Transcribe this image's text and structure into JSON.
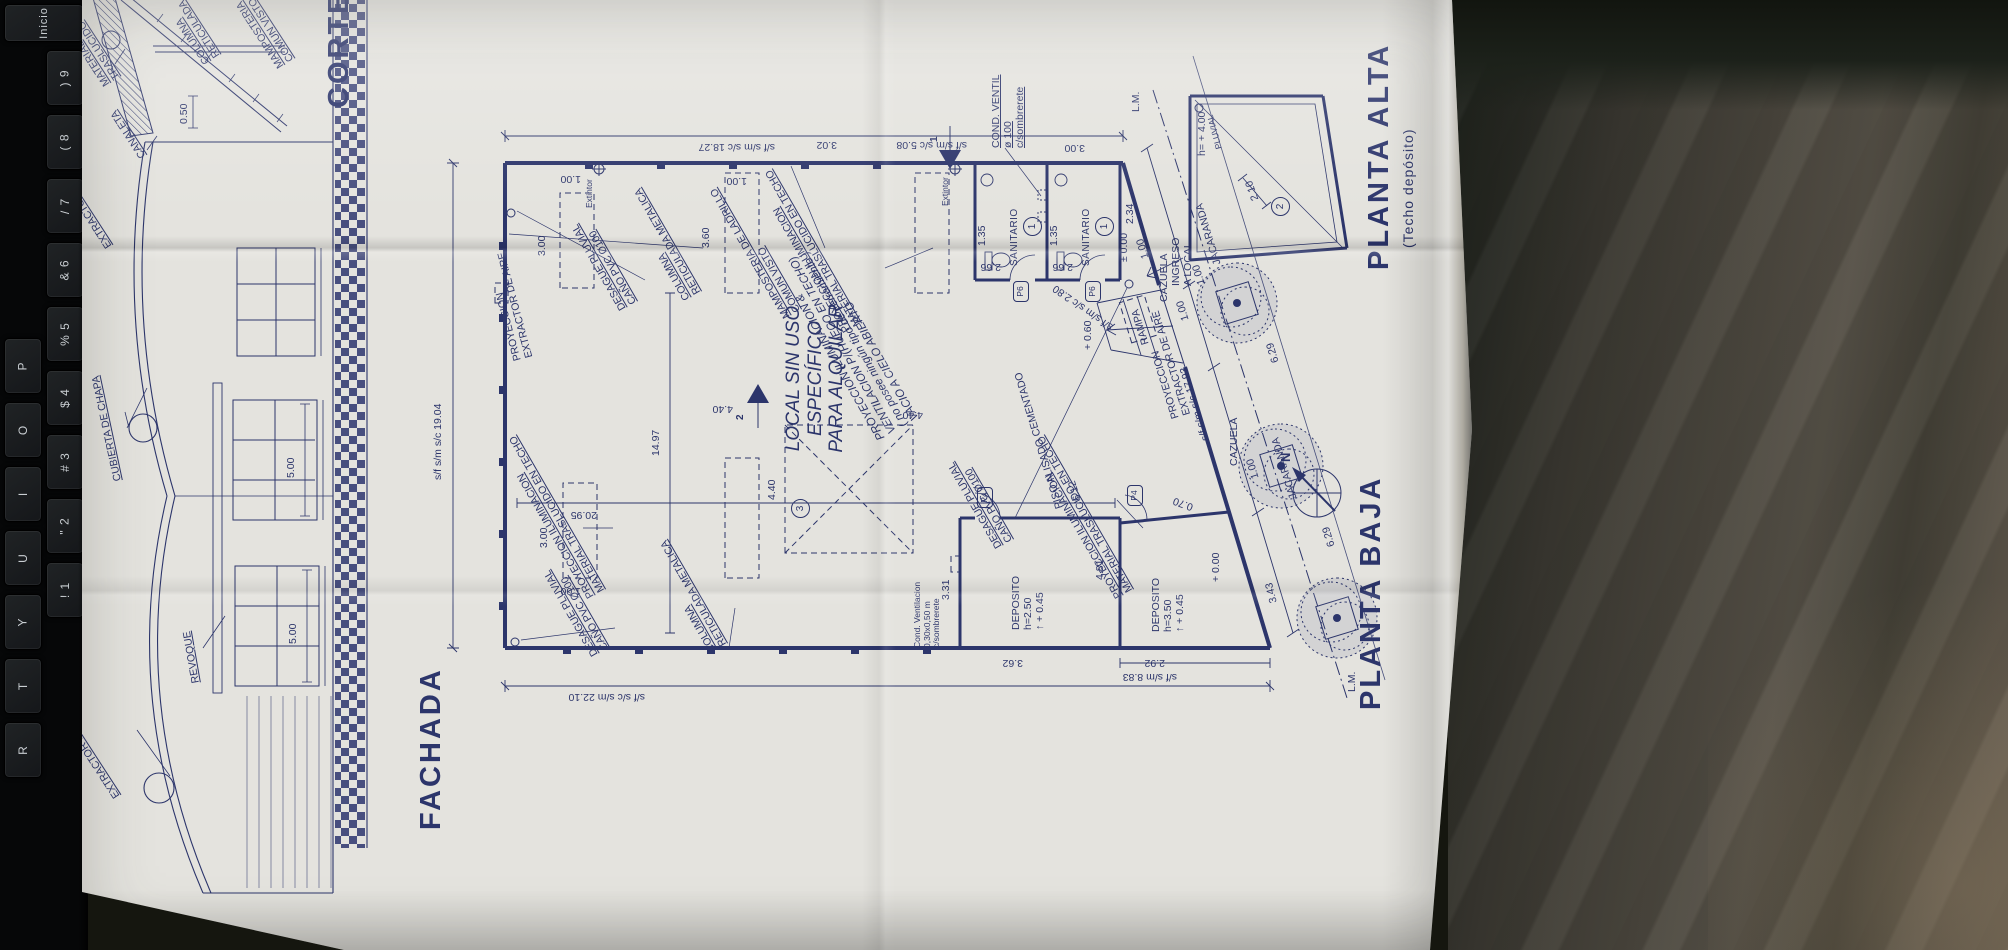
{
  "colors": {
    "ink": "#2c356b",
    "paper": "#e4e3de",
    "band": "#3a4277",
    "keyboard_key": "#1a1c1f",
    "key_text": "#c9ced2"
  },
  "keyboard": {
    "keys": [
      {
        "t": "Inicio",
        "x": 4,
        "y": 4,
        "w": 78,
        "h": 36,
        "fs": 11
      },
      {
        "t": ") 9",
        "x": 46,
        "y": 50,
        "w": 36,
        "h": 54
      },
      {
        "t": "( 8",
        "x": 46,
        "y": 114,
        "w": 36,
        "h": 54
      },
      {
        "t": "/ 7",
        "x": 46,
        "y": 178,
        "w": 36,
        "h": 54
      },
      {
        "t": "& 6",
        "x": 46,
        "y": 242,
        "w": 36,
        "h": 54
      },
      {
        "t": "% 5",
        "x": 46,
        "y": 306,
        "w": 36,
        "h": 54
      },
      {
        "t": "$ 4",
        "x": 46,
        "y": 370,
        "w": 36,
        "h": 54
      },
      {
        "t": "# 3",
        "x": 46,
        "y": 434,
        "w": 36,
        "h": 54
      },
      {
        "t": "\" 2",
        "x": 46,
        "y": 498,
        "w": 36,
        "h": 54
      },
      {
        "t": "! 1",
        "x": 46,
        "y": 562,
        "w": 36,
        "h": 54
      },
      {
        "t": "P",
        "x": 4,
        "y": 338,
        "w": 36,
        "h": 54
      },
      {
        "t": "O",
        "x": 4,
        "y": 402,
        "w": 36,
        "h": 54
      },
      {
        "t": "I",
        "x": 4,
        "y": 466,
        "w": 36,
        "h": 54
      },
      {
        "t": "U",
        "x": 4,
        "y": 530,
        "w": 36,
        "h": 54
      },
      {
        "t": "Y",
        "x": 4,
        "y": 594,
        "w": 36,
        "h": 54
      },
      {
        "t": "T",
        "x": 4,
        "y": 658,
        "w": 36,
        "h": 54
      },
      {
        "t": "R",
        "x": 4,
        "y": 722,
        "w": 36,
        "h": 54
      }
    ]
  },
  "titles": {
    "fachada": "FACHADA",
    "corte": "CORTE",
    "planta_baja": "PLANTA BAJA",
    "planta_alta": "PLANTA ALTA",
    "planta_alta_sub": "(Techo depósito)"
  },
  "labels": [
    {
      "n": "label-material-traslucido",
      "t": "MATERIAL TRASLUCIDO",
      "c": "lblu",
      "x": 860,
      "y": 18,
      "r": -33
    },
    {
      "n": "label-columna-reticulada-corte",
      "t": "COLUMNA\nRETICULADA",
      "c": "lblu",
      "x": 882,
      "y": 118,
      "r": -33
    },
    {
      "n": "label-mamposteria-corte",
      "t": "MAMPOSTERIA\nCOMUN VISTO",
      "c": "lblu",
      "x": 878,
      "y": 192,
      "r": -33
    },
    {
      "n": "label-canaleta",
      "t": "CANALETA",
      "c": "lblu",
      "x": 788,
      "y": 54,
      "r": -33
    },
    {
      "n": "dim-corte-050",
      "t": "0.50",
      "c": "dim",
      "x": 824,
      "y": 94,
      "r": 0
    },
    {
      "n": "label-extractor-corte",
      "t": "EXTRACTOR DE AIRE ø 0,80 m",
      "c": "lblu",
      "x": 698,
      "y": 20,
      "r": -33
    },
    {
      "n": "label-extractor-fachada",
      "t": "EXTRACTOR DE AIRE ø 0,80 m",
      "c": "lblu",
      "x": 148,
      "y": 28,
      "r": -33
    },
    {
      "n": "label-cubierta-chapa",
      "t": "CUBIERTA DE CHAPA",
      "c": "lblu",
      "x": 466,
      "y": 28,
      "r": -12
    },
    {
      "n": "label-revoque",
      "t": "REVOQUE",
      "c": "lblu",
      "x": 264,
      "y": 106,
      "r": -10
    },
    {
      "n": "dim-window-500-a",
      "t": "5.00",
      "c": "dim",
      "x": 304,
      "y": 203,
      "r": 0
    },
    {
      "n": "dim-window-500-b",
      "t": "5.00",
      "c": "dim",
      "x": 470,
      "y": 201,
      "r": 0
    },
    {
      "n": "title-fachada",
      "t": "FACHADA",
      "c": "ttl",
      "x": 118,
      "y": 330,
      "r": 0
    },
    {
      "n": "title-corte",
      "t": "CORTE",
      "c": "ttl",
      "x": 840,
      "y": 238,
      "r": 0
    },
    {
      "n": "dim-chain-top",
      "t": "s/f s/m s/c 19.04",
      "c": "dim",
      "x": 468,
      "y": 348,
      "r": 0
    },
    {
      "n": "dim-chain-right",
      "t": "s/f s/m s/c 18.27",
      "c": "dim",
      "x": 796,
      "y": 690,
      "r": -90
    },
    {
      "n": "dim-chain-left",
      "t": "s/f s/c s/m 22.10",
      "c": "dim",
      "x": 246,
      "y": 560,
      "r": -90
    },
    {
      "n": "dim-hall-width",
      "t": "14.97",
      "c": "dim",
      "x": 492,
      "y": 566,
      "r": 0
    },
    {
      "n": "dim-hall-length",
      "t": "20.95",
      "c": "dim",
      "x": 428,
      "y": 512,
      "r": -90
    },
    {
      "n": "dim-chain-883",
      "t": "s/f s/m 8.83",
      "c": "dim",
      "x": 266,
      "y": 1092,
      "r": -90
    },
    {
      "n": "dim-front-1793",
      "t": "s/f s/m s/c 17.93",
      "c": "dim",
      "x": 506,
      "y": 1116,
      "r": -17
    },
    {
      "n": "dim-front-280",
      "t": "s/f s/m s/c 2.80",
      "c": "dim",
      "x": 616,
      "y": 1024,
      "r": -55
    },
    {
      "n": "dim-right-508",
      "t": "s/f s/m s/c 5.08",
      "c": "dim",
      "x": 798,
      "y": 882,
      "r": -90
    },
    {
      "n": "dim-right-302",
      "t": "3.02",
      "c": "dim",
      "x": 798,
      "y": 752,
      "r": -90
    },
    {
      "n": "dim-right-300",
      "t": "3.00",
      "c": "dim",
      "x": 795,
      "y": 1000,
      "r": -90
    },
    {
      "n": "dim-sidewalk-629-a",
      "t": "6.29",
      "c": "dim",
      "x": 584,
      "y": 1186,
      "r": -17
    },
    {
      "n": "dim-sidewalk-629-b",
      "t": "6.29",
      "c": "dim",
      "x": 400,
      "y": 1242,
      "r": -17
    },
    {
      "n": "dim-612",
      "t": "6.12",
      "c": "dim",
      "x": 446,
      "y": 988,
      "r": -17
    },
    {
      "n": "label-proy-extractor-top",
      "t": "PROYECCION\nEXTRACTOR DE AIRE",
      "c": "lbl",
      "x": 586,
      "y": 428,
      "r": -15
    },
    {
      "n": "dim-skylight-300-r",
      "t": "3.00",
      "c": "dim",
      "x": 692,
      "y": 452,
      "r": 0
    },
    {
      "n": "dim-skylight-100-r",
      "t": "1.00",
      "c": "dim",
      "x": 764,
      "y": 496,
      "r": -90
    },
    {
      "n": "dim-skylight-360-r",
      "t": "3.60",
      "c": "dim",
      "x": 700,
      "y": 616,
      "r": 0
    },
    {
      "n": "dim-skylight-100-r2",
      "t": "1.00",
      "c": "dim",
      "x": 762,
      "y": 662,
      "r": -90
    },
    {
      "n": "dim-skylight-300-l",
      "t": "3.00",
      "c": "dim",
      "x": 400,
      "y": 454,
      "r": 0
    },
    {
      "n": "dim-skylight-100-l",
      "t": "1.00",
      "c": "dim",
      "x": 352,
      "y": 496,
      "r": -90
    },
    {
      "n": "dim-440-a",
      "t": "4.40",
      "c": "dim",
      "x": 534,
      "y": 648,
      "r": -90
    },
    {
      "n": "dim-440-b",
      "t": "4.40",
      "c": "dim",
      "x": 448,
      "y": 682,
      "r": 0
    },
    {
      "n": "dim-440-c",
      "t": "4.40",
      "c": "dim",
      "x": 528,
      "y": 838,
      "r": -90
    },
    {
      "n": "label-proy-iluminacion-a",
      "t": "PROYECCION ILUMINACION\nMATERIAL TRASLUCIDO EN TECHO",
      "c": "lblu",
      "x": 348,
      "y": 502,
      "r": -30
    },
    {
      "n": "label-proy-iluminacion-b",
      "t": "PROYECCION ILUMINACION\nMATERIAL TRASLUCIDO EN TECHO",
      "c": "lblu",
      "x": 614,
      "y": 758,
      "r": -30
    },
    {
      "n": "label-proy-iluminacion-c",
      "t": "PROYECCION ILUMINACION\nMATERIAL TRASLUCIDO EN TECHO",
      "c": "lblu",
      "x": 348,
      "y": 1030,
      "r": -30
    },
    {
      "n": "label-mamposteria-plan",
      "t": "MAMPOSTERIA DE LADRILLO\nCOMUN VISTO",
      "c": "lblu",
      "x": 628,
      "y": 698,
      "r": -30
    },
    {
      "n": "label-desague-a",
      "t": "DESAGUE PLUVIAL\nCAÑO PVC Ø100",
      "c": "lblu",
      "x": 636,
      "y": 534,
      "r": -30
    },
    {
      "n": "label-desague-b",
      "t": "DESAGUE PLUVIAL\nCAÑO PVC Ø100",
      "c": "lblu",
      "x": 290,
      "y": 506,
      "r": -30
    },
    {
      "n": "label-desague-c",
      "t": "DESAGUE PLUVIAL\nCAÑO PVC Ø100",
      "c": "lblu",
      "x": 398,
      "y": 910,
      "r": -30
    },
    {
      "n": "label-columna-a",
      "t": "COLUMNA\nRETICULADA METALICA",
      "c": "lblu",
      "x": 646,
      "y": 598,
      "r": -30
    },
    {
      "n": "label-columna-b",
      "t": "COLUMNA\nRETICULADA METALICA",
      "c": "lblu",
      "x": 294,
      "y": 624,
      "r": -30
    },
    {
      "n": "label-local",
      "t": "LOCAL SIN USO ESPECÍFICO\nPARA ALQUILAR",
      "c": "big",
      "x": 452,
      "y": 698,
      "r": 0
    },
    {
      "n": "tag-local-3",
      "t": "3",
      "c": "circ",
      "x": 430,
      "y": 706,
      "r": 0
    },
    {
      "n": "label-vacio",
      "t": "PROYECCION ILUMINACION &\nVENTILACION P/(HUECO EN TECHO)\n( no posee ningún tipo de cerramiento )\nVACIO A CIELO ABIERTO",
      "c": "it",
      "x": 506,
      "y": 792,
      "r": -30
    },
    {
      "n": "label-extintor-a",
      "t": "Extintor",
      "c": "tiny",
      "x": 740,
      "y": 500,
      "r": 0
    },
    {
      "n": "label-extintor-b",
      "t": "Extintor",
      "c": "tiny",
      "x": 742,
      "y": 856,
      "r": 0
    },
    {
      "n": "mark-section-1",
      "t": "1",
      "c": "mark",
      "x": 806,
      "y": 844,
      "r": 0
    },
    {
      "n": "mark-section-2",
      "t": "2",
      "c": "mark",
      "x": 528,
      "y": 650,
      "r": 0
    },
    {
      "n": "label-sanitario-1",
      "t": "SANITARIO",
      "c": "l10",
      "x": 682,
      "y": 924,
      "r": 0
    },
    {
      "n": "label-sanitario-2",
      "t": "SANITARIO",
      "c": "l10",
      "x": 682,
      "y": 996,
      "r": 0
    },
    {
      "n": "tag-sanitario-1",
      "t": "1",
      "c": "circ",
      "x": 712,
      "y": 938,
      "r": 0
    },
    {
      "n": "tag-sanitario-2",
      "t": "1",
      "c": "circ",
      "x": 712,
      "y": 1010,
      "r": 0
    },
    {
      "n": "tag-door-p6-a",
      "t": "P6",
      "c": "hex",
      "x": 646,
      "y": 928,
      "r": 0
    },
    {
      "n": "tag-door-p6-b",
      "t": "P6",
      "c": "hex",
      "x": 646,
      "y": 1000,
      "r": 0
    },
    {
      "n": "dim-sanit-266-a",
      "t": "2.66",
      "c": "dim",
      "x": 676,
      "y": 916,
      "r": -90
    },
    {
      "n": "dim-sanit-266-b",
      "t": "2.66",
      "c": "dim",
      "x": 676,
      "y": 988,
      "r": -90
    },
    {
      "n": "dim-sanit-135-a",
      "t": "1.35",
      "c": "dim",
      "x": 702,
      "y": 892,
      "r": 0
    },
    {
      "n": "dim-sanit-135-b",
      "t": "1.35",
      "c": "dim",
      "x": 702,
      "y": 964,
      "r": 0
    },
    {
      "n": "dim-sanit-234",
      "t": "2.34",
      "c": "dim",
      "x": 724,
      "y": 1040,
      "r": 0
    },
    {
      "n": "dim-sanit-100",
      "t": "1.00",
      "c": "dim",
      "x": 688,
      "y": 1056,
      "r": -17
    },
    {
      "n": "label-cond-ventil",
      "t": "COND. VENTIL\nø 100\nc/sombrerete",
      "c": "lblu",
      "x": 800,
      "y": 906,
      "r": 0
    },
    {
      "n": "label-ingreso",
      "t": "INGRESO\nA LOCAL",
      "c": "lbl",
      "x": 662,
      "y": 1086,
      "r": 0
    },
    {
      "n": "label-rampa",
      "t": "RAMPA",
      "c": "lbl",
      "x": 602,
      "y": 1056,
      "r": -17
    },
    {
      "n": "dim-level-000",
      "t": "± 0.00",
      "c": "dim",
      "x": 686,
      "y": 1034,
      "r": 0
    },
    {
      "n": "dim-level-060",
      "t": "+ 0.60",
      "c": "dim",
      "x": 598,
      "y": 998,
      "r": 0
    },
    {
      "n": "label-piso-alisado",
      "t": "PISO ALISADO CEMENTADO",
      "c": "lbl",
      "x": 438,
      "y": 970,
      "r": -17
    },
    {
      "n": "label-proy-extractor-front",
      "t": "PROYECCION\nEXTRACTOR DE AIRE",
      "c": "lbl",
      "x": 528,
      "y": 1086,
      "r": -17
    },
    {
      "n": "dim-street-000",
      "t": "+ 0.00",
      "c": "dim",
      "x": 366,
      "y": 1126,
      "r": 0
    },
    {
      "n": "label-lm-a",
      "t": "L.M.",
      "c": "lbl",
      "x": 836,
      "y": 1046,
      "r": 0
    },
    {
      "n": "label-lm-b",
      "t": "L.M.",
      "c": "lbl",
      "x": 256,
      "y": 1262,
      "r": 0
    },
    {
      "n": "label-deposito-1",
      "t": "DEPOSITO\nh=2.50\n↑ + 0.45",
      "c": "lbl",
      "x": 318,
      "y": 926,
      "r": 0
    },
    {
      "n": "label-deposito-2",
      "t": "DEPOSITO\nh=3.50\n↑ + 0.45",
      "c": "lbl",
      "x": 316,
      "y": 1066,
      "r": 0
    },
    {
      "n": "dim-dep-331",
      "t": "3.31",
      "c": "dim",
      "x": 348,
      "y": 856,
      "r": 0
    },
    {
      "n": "dim-dep-362",
      "t": "3.62",
      "c": "dim",
      "x": 280,
      "y": 938,
      "r": -90
    },
    {
      "n": "dim-dep-292",
      "t": "2.92",
      "c": "dim",
      "x": 280,
      "y": 1080,
      "r": -90
    },
    {
      "n": "dim-dep-343",
      "t": "3.43",
      "c": "dim",
      "x": 344,
      "y": 1184,
      "r": -14
    },
    {
      "n": "dim-dep-481",
      "t": "4.81",
      "c": "dim",
      "x": 368,
      "y": 1010,
      "r": 0
    },
    {
      "n": "dim-dep-070",
      "t": "0.70",
      "c": "dim",
      "x": 436,
      "y": 1106,
      "r": -70
    },
    {
      "n": "tag-door-p4-a",
      "t": "P4",
      "c": "hex",
      "x": 440,
      "y": 892,
      "r": 0
    },
    {
      "n": "tag-door-p4-b",
      "t": "P4",
      "c": "hex",
      "x": 442,
      "y": 1042,
      "r": 0
    },
    {
      "n": "label-cond-vent-dep",
      "t": "Cond. Ventilacion\n0,30x0,50 m\nc/sombrerete",
      "c": "tiny",
      "x": 300,
      "y": 828,
      "r": 0
    },
    {
      "n": "label-cazuela-a",
      "t": "CAZUELA",
      "c": "lbl",
      "x": 646,
      "y": 1074,
      "r": 0
    },
    {
      "n": "label-cazuela-b",
      "t": "CAZUELA",
      "c": "lbl",
      "x": 482,
      "y": 1144,
      "r": 0
    },
    {
      "n": "label-jacaranda-a",
      "t": "JACARANDA",
      "c": "lbl",
      "x": 682,
      "y": 1128,
      "r": -17
    },
    {
      "n": "label-jacaranda-b",
      "t": "JACARANDA",
      "c": "lbl",
      "x": 448,
      "y": 1204,
      "r": -17
    },
    {
      "n": "dim-caz-100-a",
      "t": "1.00",
      "c": "dim",
      "x": 626,
      "y": 1096,
      "r": -17
    },
    {
      "n": "dim-caz-100-b",
      "t": "1.00",
      "c": "dim",
      "x": 662,
      "y": 1112,
      "r": -17
    },
    {
      "n": "dim-caz-100-c",
      "t": "1.00",
      "c": "dim",
      "x": 468,
      "y": 1166,
      "r": -17
    },
    {
      "n": "label-north",
      "t": "N",
      "c": "nrt",
      "x": 486,
      "y": 1194,
      "r": 0
    },
    {
      "n": "dim-pa-210",
      "t": "2.10",
      "c": "dim",
      "x": 746,
      "y": 1166,
      "r": -20
    },
    {
      "n": "tag-pa-2",
      "t": "2",
      "c": "circ",
      "x": 732,
      "y": 1186,
      "r": 0
    },
    {
      "n": "dim-pa-400",
      "t": "h= + 4.00",
      "c": "dim",
      "x": 792,
      "y": 1112,
      "r": 0
    },
    {
      "n": "label-pa-pluvial",
      "t": "PLUVIAL",
      "c": "tiny",
      "x": 798,
      "y": 1130,
      "r": -15
    },
    {
      "n": "title-planta-alta",
      "t": "PLANTA ALTA",
      "c": "ttl",
      "x": 678,
      "y": 1278,
      "r": 0
    },
    {
      "n": "subtitle-planta-alta",
      "t": "(Techo depósito)",
      "c": "sub",
      "x": 700,
      "y": 1316,
      "r": 0
    },
    {
      "n": "title-planta-baja",
      "t": "PLANTA BAJA",
      "c": "ttl",
      "x": 238,
      "y": 1270,
      "r": 0
    }
  ]
}
